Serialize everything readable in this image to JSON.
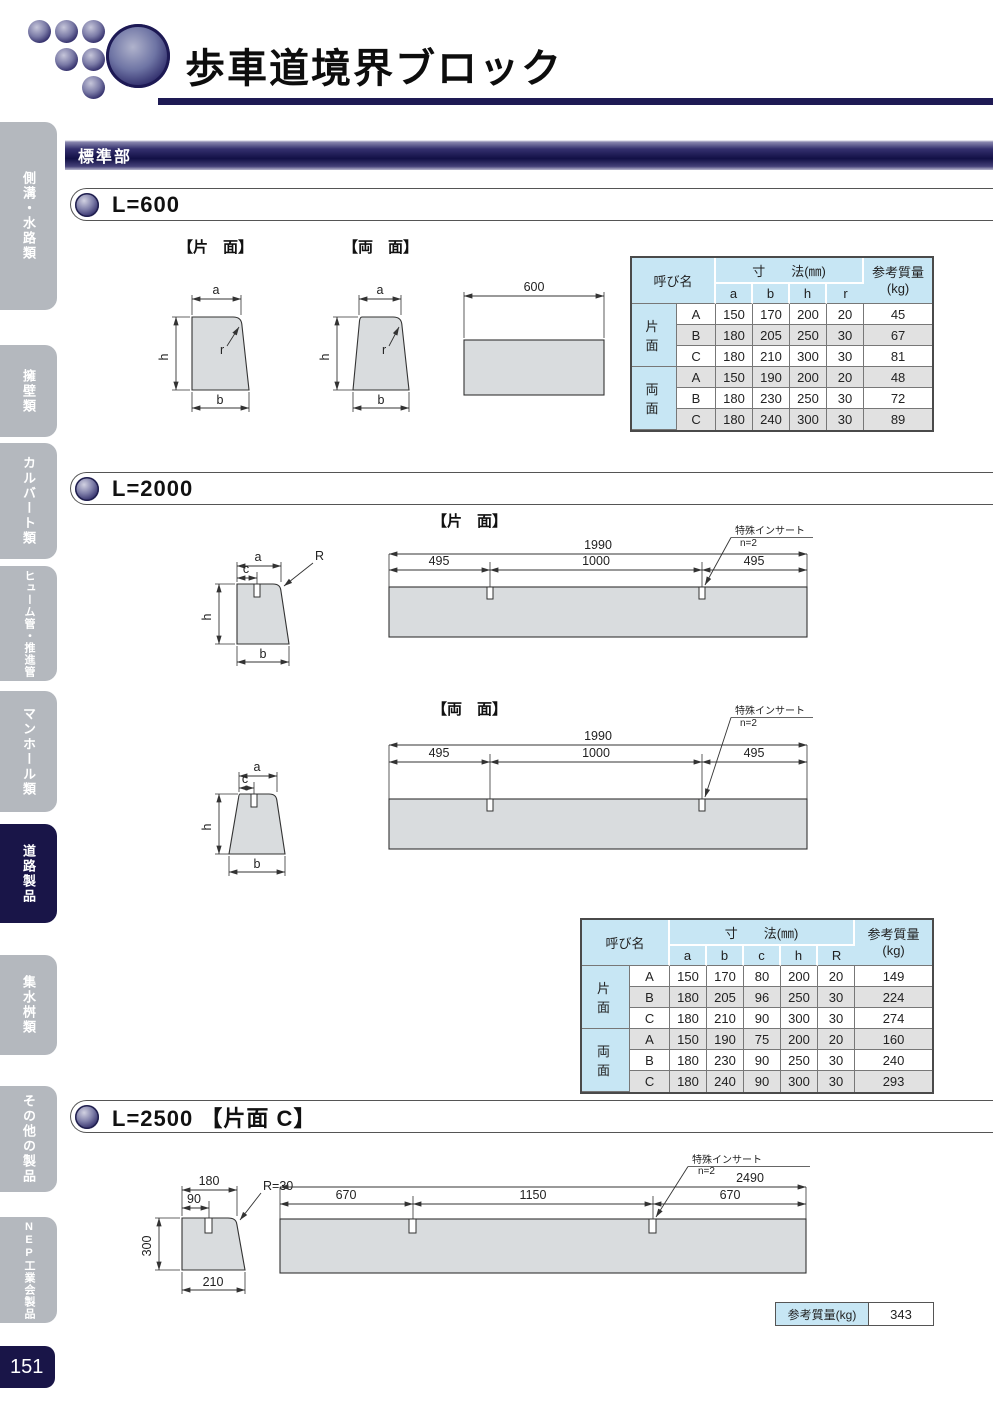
{
  "header": {
    "title": "歩車道境界ブロック"
  },
  "band_label": "標準部",
  "sidebar": {
    "items": [
      {
        "label": "側溝・水路類"
      },
      {
        "label": "擁壁類"
      },
      {
        "label": "カルバート類"
      },
      {
        "label": "ヒューム管・推進管"
      },
      {
        "label": "マンホール類"
      },
      {
        "label": "道路製品"
      },
      {
        "label": "集水桝類"
      },
      {
        "label": "その他の製品"
      },
      {
        "label": "NEP工業会製品"
      }
    ],
    "page_number": "151"
  },
  "s600": {
    "heading": "L=600",
    "katamen_label": "【片　面】",
    "ryomen_label": "【両　面】",
    "dims": {
      "a": "a",
      "b": "b",
      "h": "h",
      "r": "r"
    },
    "length": "600",
    "table": {
      "name_header": "呼び名",
      "dim_header": "寸　　法(㎜)",
      "dim_cols": [
        "a",
        "b",
        "h",
        "r"
      ],
      "mass_header": "参考質量",
      "mass_unit": "(kg)",
      "groups": [
        {
          "label": "片　面",
          "rows": [
            [
              "A",
              "150",
              "170",
              "200",
              "20",
              "45"
            ],
            [
              "B",
              "180",
              "205",
              "250",
              "30",
              "67"
            ],
            [
              "C",
              "180",
              "210",
              "300",
              "30",
              "81"
            ]
          ]
        },
        {
          "label": "両　面",
          "rows": [
            [
              "A",
              "150",
              "190",
              "200",
              "20",
              "48"
            ],
            [
              "B",
              "180",
              "230",
              "250",
              "30",
              "72"
            ],
            [
              "C",
              "180",
              "240",
              "300",
              "30",
              "89"
            ]
          ]
        }
      ]
    }
  },
  "s2000": {
    "heading": "L=2000",
    "katamen_label": "【片　面】",
    "ryomen_label": "【両　面】",
    "dims": {
      "a": "a",
      "b": "b",
      "c": "c",
      "h": "h",
      "R": "R"
    },
    "elev": {
      "total": "1990",
      "seg1": "495",
      "seg2": "1000",
      "seg3": "495"
    },
    "insert": {
      "line1": "特殊インサート",
      "line2": "n=2"
    },
    "table": {
      "name_header": "呼び名",
      "dim_header": "寸　　法(㎜)",
      "dim_cols": [
        "a",
        "b",
        "c",
        "h",
        "R"
      ],
      "mass_header": "参考質量",
      "mass_unit": "(kg)",
      "groups": [
        {
          "label": "片　面",
          "rows": [
            [
              "A",
              "150",
              "170",
              "80",
              "200",
              "20",
              "149"
            ],
            [
              "B",
              "180",
              "205",
              "96",
              "250",
              "30",
              "224"
            ],
            [
              "C",
              "180",
              "210",
              "90",
              "300",
              "30",
              "274"
            ]
          ]
        },
        {
          "label": "両　面",
          "rows": [
            [
              "A",
              "150",
              "190",
              "75",
              "200",
              "20",
              "160"
            ],
            [
              "B",
              "180",
              "230",
              "90",
              "250",
              "30",
              "240"
            ],
            [
              "C",
              "180",
              "240",
              "90",
              "300",
              "30",
              "293"
            ]
          ]
        }
      ]
    }
  },
  "s2500": {
    "heading": "L=2500 【片面 C】",
    "dims": {
      "top": "180",
      "offset": "90",
      "radius": "R=30",
      "height": "300",
      "bottom": "210"
    },
    "elev": {
      "total": "2490",
      "seg1": "670",
      "seg2": "1150",
      "seg3": "670"
    },
    "insert": {
      "line1": "特殊インサート",
      "line2": "n=2"
    },
    "mass": {
      "label": "参考質量(kg)",
      "value": "343"
    }
  }
}
